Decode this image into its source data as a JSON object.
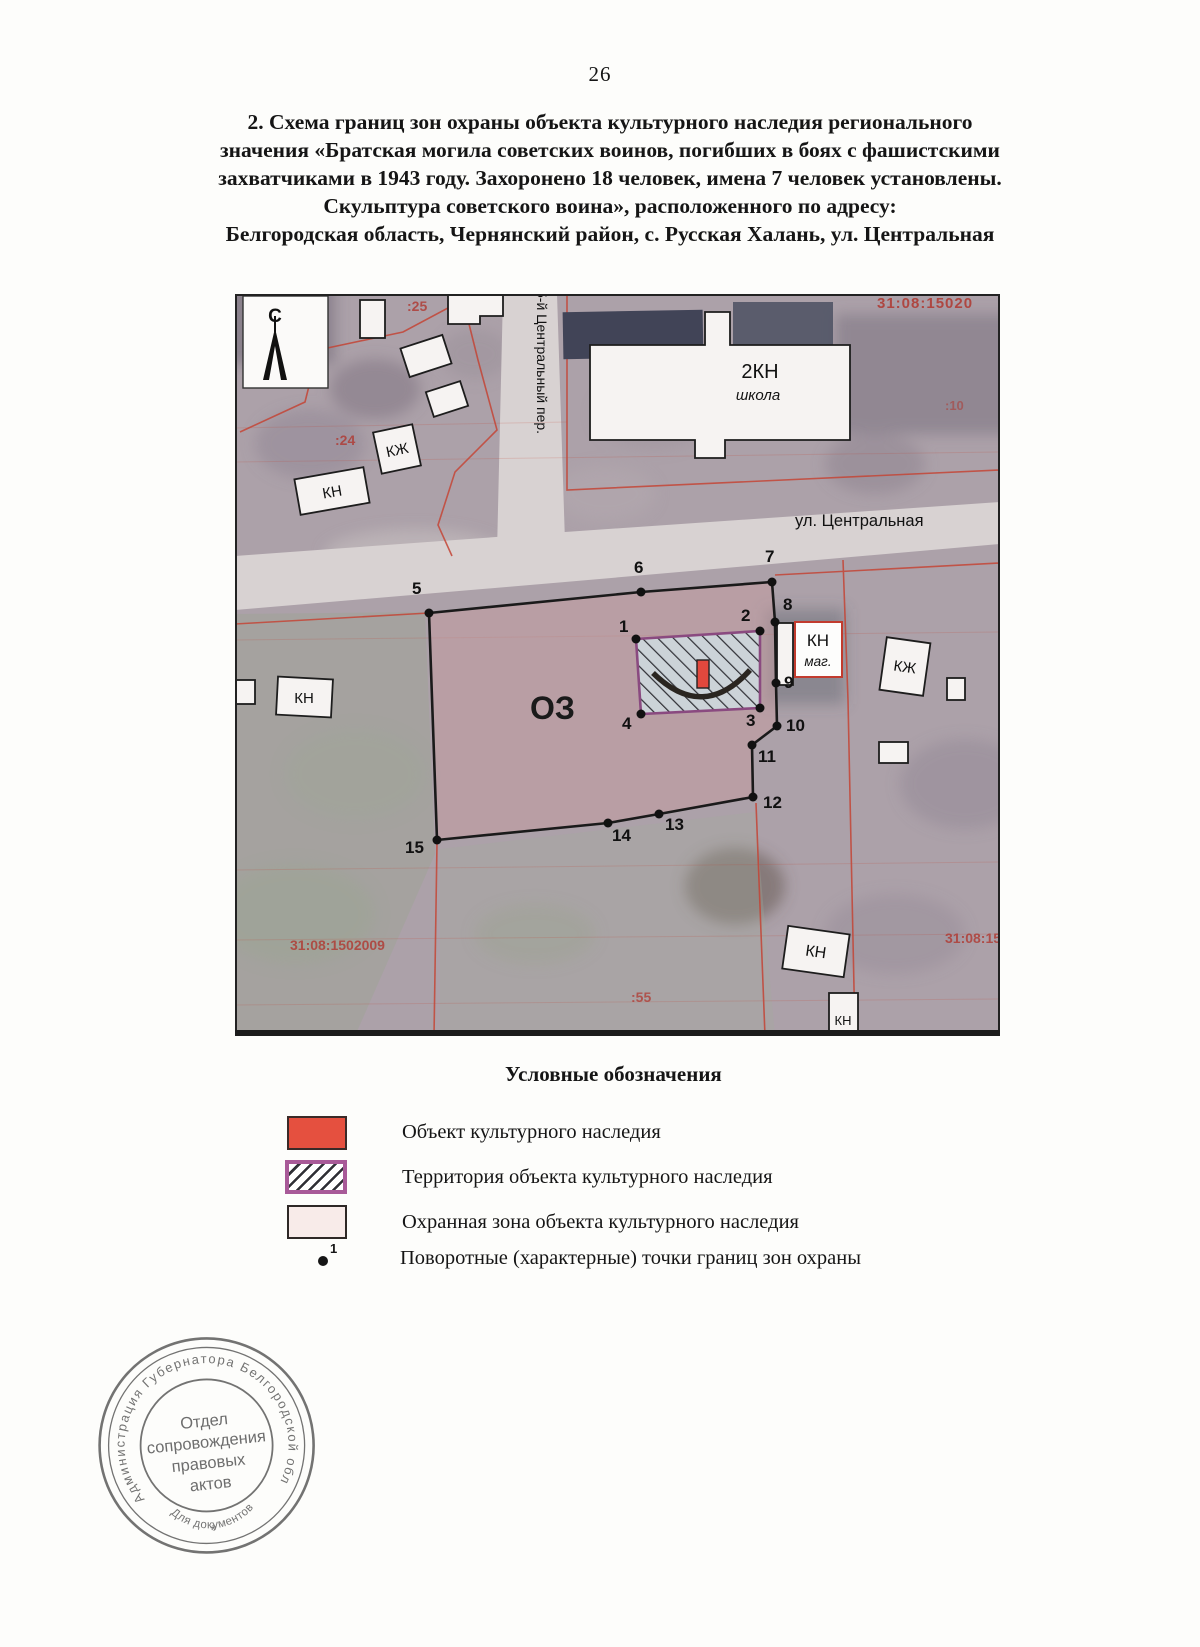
{
  "page_number": "26",
  "title": {
    "line1": "2. Схема границ зон охраны объекта культурного наследия регионального",
    "line2": "значения «Братская могила советских воинов, погибших в боях с фашистскими",
    "line3": "захватчиками в 1943 году. Захоронено 18 человек, имена 7 человек установлены.",
    "line4": "Скульптура советского воина», расположенного по адресу:",
    "line5": "Белгородская область, Чернянский район, с. Русская Халань, ул. Центральная"
  },
  "map": {
    "north_label": "С",
    "street_vertical": "5-й Центральный пер.",
    "street_horizontal": "ул. Центральная",
    "zone_label": "ОЗ",
    "school_label1": "2КН",
    "school_label2": "школа",
    "labels": {
      "kn": "КН",
      "kzh": "КЖ",
      "mag": "маг."
    },
    "cadastral": {
      "top_right": "31:08:15020",
      "bottom_left": "31:08:1502009",
      "bottom_right": "31:08:15",
      "parcel_25": ":25",
      "parcel_24": ":24",
      "parcel_10": ":10",
      "parcel_55": ":55"
    },
    "points": [
      {
        "n": "1",
        "x": 401,
        "y": 345,
        "lx": 384,
        "ly": 338
      },
      {
        "n": "2",
        "x": 525,
        "y": 337,
        "lx": 506,
        "ly": 327
      },
      {
        "n": "3",
        "x": 525,
        "y": 414,
        "lx": 511,
        "ly": 432
      },
      {
        "n": "4",
        "x": 406,
        "y": 420,
        "lx": 387,
        "ly": 435
      },
      {
        "n": "5",
        "x": 194,
        "y": 319,
        "lx": 177,
        "ly": 300
      },
      {
        "n": "6",
        "x": 406,
        "y": 298,
        "lx": 399,
        "ly": 279
      },
      {
        "n": "7",
        "x": 537,
        "y": 288,
        "lx": 530,
        "ly": 268
      },
      {
        "n": "8",
        "x": 540,
        "y": 328,
        "lx": 548,
        "ly": 316
      },
      {
        "n": "9",
        "x": 541,
        "y": 389,
        "lx": 549,
        "ly": 394
      },
      {
        "n": "10",
        "x": 542,
        "y": 432,
        "lx": 551,
        "ly": 437
      },
      {
        "n": "11",
        "x": 517,
        "y": 451,
        "lx": 523,
        "ly": 468
      },
      {
        "n": "12",
        "x": 518,
        "y": 503,
        "lx": 528,
        "ly": 514
      },
      {
        "n": "13",
        "x": 424,
        "y": 520,
        "lx": 430,
        "ly": 536
      },
      {
        "n": "14",
        "x": 373,
        "y": 529,
        "lx": 377,
        "ly": 547
      },
      {
        "n": "15",
        "x": 202,
        "y": 546,
        "lx": 170,
        "ly": 559
      }
    ]
  },
  "legend": {
    "heading": "Условные обозначения",
    "item1": "Объект культурного наследия",
    "item2": "Территория объекта культурного наследия",
    "item3": "Охранная зона объекта культурного наследия",
    "item4": "Поворотные (характерные) точки границ зон охраны",
    "point_symbol_label": "1",
    "colors": {
      "object_red": "#e5503f",
      "territory_border_purple": "#a85a98",
      "protection_zone_fill": "#f8ebe9",
      "cadastral_line_red": "#c44536"
    }
  },
  "stamp": {
    "ring": "Администрация Губернатора Белгородской области",
    "center1": "Отдел",
    "center2": "сопровождения",
    "center3": "правовых",
    "center4": "актов",
    "bottom": "Для документов",
    "star": "*"
  }
}
